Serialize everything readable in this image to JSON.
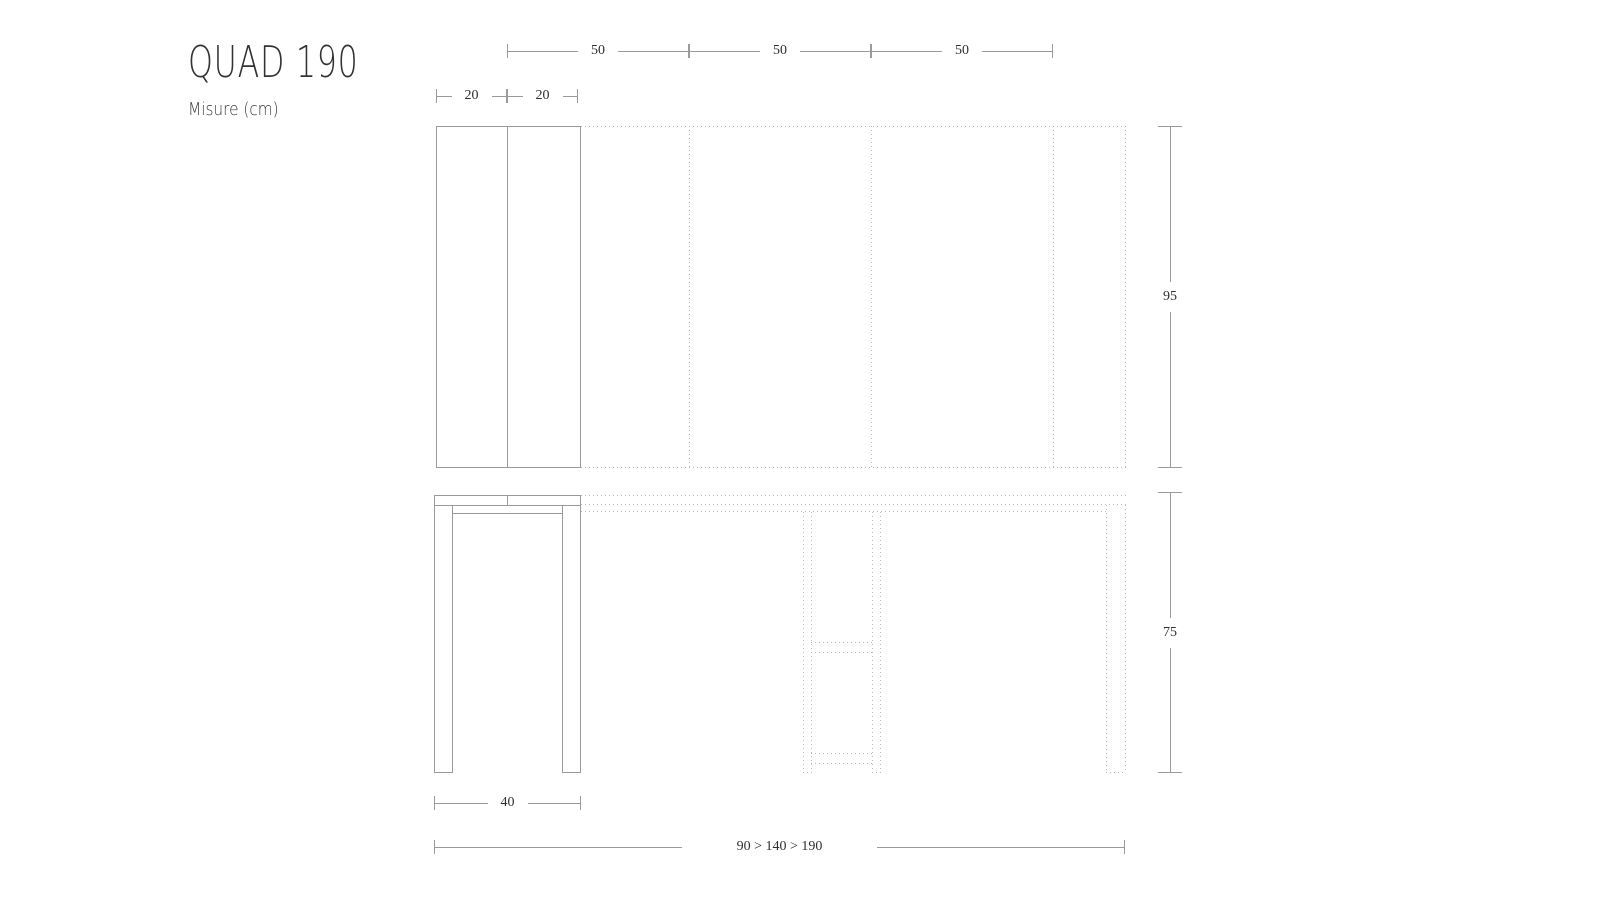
{
  "title": "QUAD 190",
  "subtitle": "Misure (cm)",
  "colors": {
    "line": "#9b9b9b",
    "dot": "#b9b9b9",
    "text": "#2f2f2f",
    "title": "#333333",
    "bg": "#ffffff"
  },
  "dims": {
    "leaf_segments": [
      "50",
      "50",
      "50"
    ],
    "closed_halves": [
      "20",
      "20"
    ],
    "depth": "95",
    "height": "75",
    "base_width": "40",
    "width_range": "90 > 140 > 190"
  }
}
